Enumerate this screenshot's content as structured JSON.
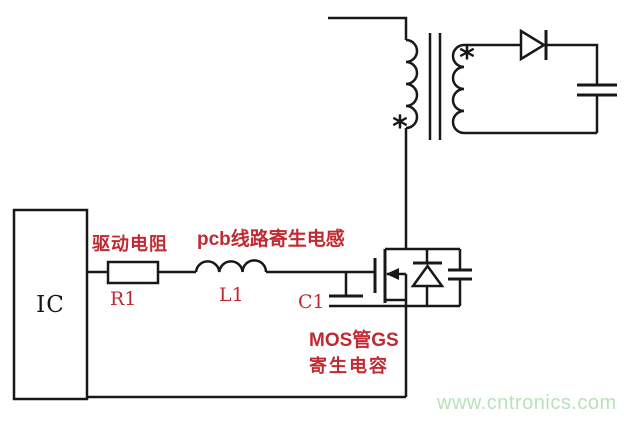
{
  "colors": {
    "wire": "#181818",
    "label_red": "#c12a32",
    "watermark_green": "#b9e2b9",
    "background": "#ffffff"
  },
  "ic": {
    "label": "IC"
  },
  "labels": {
    "drive_resistor": "驱动电阻",
    "pcb_parasitic_inductance": "pcb线路寄生电感",
    "r1": "R1",
    "l1": "L1",
    "c1": "C1",
    "mos_gs_line1": "MOS管GS",
    "mos_gs_line2": "寄生电容"
  },
  "transformer": {
    "primary_dot": "*",
    "secondary_dot": "*"
  },
  "watermark": {
    "text": "www.cntronics.com"
  }
}
